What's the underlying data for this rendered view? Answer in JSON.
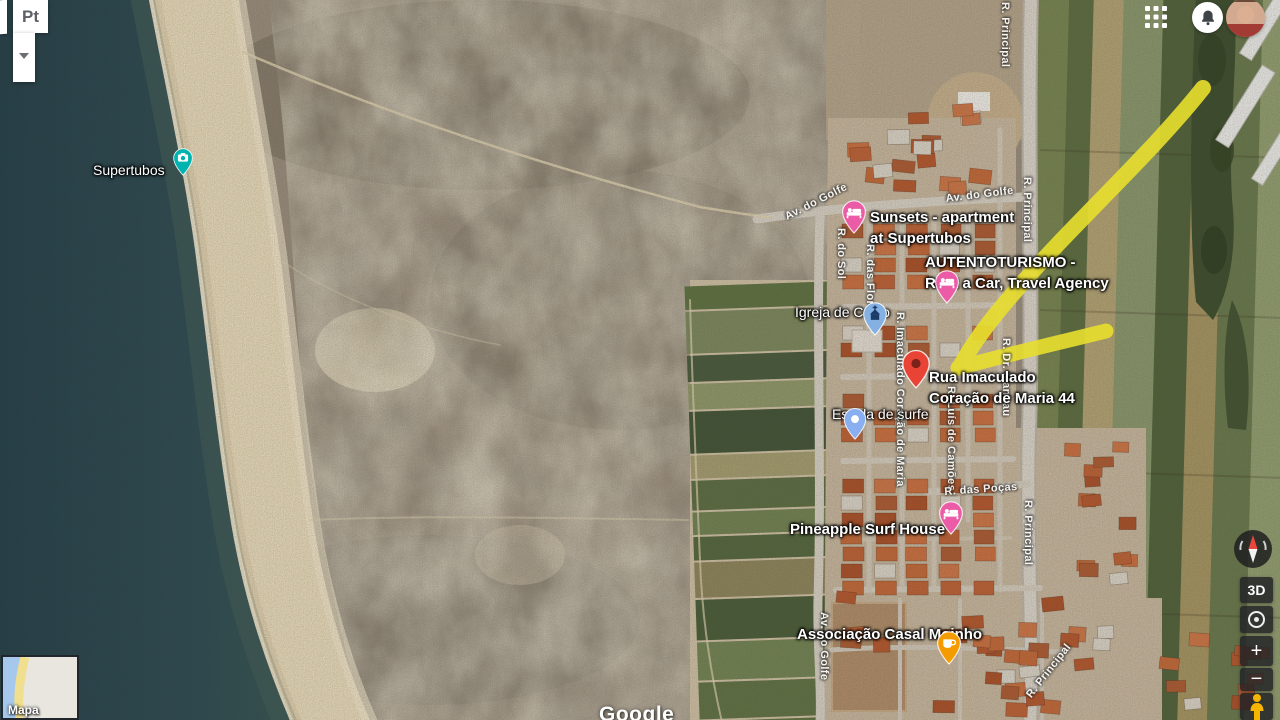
{
  "ui": {
    "language": {
      "label": "Pt"
    },
    "topbar": {
      "apps_grid_icon": "apps-grid-icon",
      "notifications_icon": "bell-icon",
      "avatar": "user-avatar"
    },
    "controls": {
      "compass_icon": "compass-icon",
      "three_d_label": "3D",
      "my_location_icon": "my-location-icon",
      "zoom_in_label": "+",
      "zoom_out_label": "−",
      "pegman_icon": "pegman-icon"
    },
    "minimap": {
      "label": "Mapa"
    },
    "watermark": "Google"
  },
  "colors": {
    "annotation_arrow": "#e8df2e",
    "water": "#27434c",
    "sand": "#e6d8b8",
    "destination_pin": "#e94335",
    "destination_pin_hole": "#7a211a",
    "lodging_pin": "#ec5ba6",
    "photo_pin": "#00b3af",
    "church_pin": "#84b1e2",
    "church_icon": "#1c3a66",
    "cafe_pin": "#f49b00",
    "poi_pin": "#8aaff0"
  },
  "poi_labels": [
    {
      "name": "label-supertubos",
      "lines": [
        "Supertubos"
      ],
      "x": 93,
      "y": 160,
      "size": 14,
      "weight": "400"
    },
    {
      "name": "label-sunsets-apartment",
      "lines": [
        "Sunsets - apartment",
        "at Supertubos"
      ],
      "x": 870,
      "y": 207,
      "size": 15,
      "weight": "700"
    },
    {
      "name": "label-autentoturismo",
      "lines": [
        "AUTENTOTURISMO -",
        "Rent a Car, Travel Agency"
      ],
      "x": 925,
      "y": 252,
      "size": 15,
      "weight": "700"
    },
    {
      "name": "label-igreja-de-cristo",
      "lines": [
        "Igreja de Cristo"
      ],
      "x": 795,
      "y": 302,
      "size": 14,
      "weight": "400"
    },
    {
      "name": "label-rua-imaculado-44",
      "lines": [
        "Rua Imaculado",
        "Coração de Maria 44"
      ],
      "x": 929,
      "y": 367,
      "size": 15,
      "weight": "700"
    },
    {
      "name": "label-escola-de-surfe",
      "lines": [
        "Escola de surfe"
      ],
      "x": 832,
      "y": 404,
      "size": 14,
      "weight": "400"
    },
    {
      "name": "label-pineapple-surf-house",
      "lines": [
        "Pineapple Surf House"
      ],
      "x": 790,
      "y": 519,
      "size": 15,
      "weight": "700"
    },
    {
      "name": "label-associacao-casal-moinho",
      "lines": [
        "Associação Casal Moinho"
      ],
      "x": 797,
      "y": 624,
      "size": 15,
      "weight": "700"
    }
  ],
  "road_labels": [
    {
      "text": "Av. do Golfe",
      "x": 783,
      "y": 212,
      "rotate": -27
    },
    {
      "text": "Av. do Golfe",
      "x": 945,
      "y": 193,
      "rotate": -7
    },
    {
      "text": "R. Principal",
      "x": 999,
      "y": 2,
      "vertical": true
    },
    {
      "text": "R. Principal",
      "x": 1021,
      "y": 177,
      "vertical": true
    },
    {
      "text": "R. do Sol",
      "x": 835,
      "y": 228,
      "vertical": true
    },
    {
      "text": "R. das Flores",
      "x": 864,
      "y": 244,
      "vertical": true
    },
    {
      "text": "R. Imaculado Coração de Maria",
      "x": 894,
      "y": 312,
      "vertical": true
    },
    {
      "text": "R. Luís de Camões",
      "x": 945,
      "y": 386,
      "vertical": true
    },
    {
      "text": "R. Dr. Manhau",
      "x": 1000,
      "y": 338,
      "vertical": true
    },
    {
      "text": "R. das Poças",
      "x": 944,
      "y": 486,
      "rotate": -4
    },
    {
      "text": "R. Principal",
      "x": 1022,
      "y": 500,
      "vertical": true
    },
    {
      "text": "Av. do Golfe",
      "x": 818,
      "y": 612,
      "vertical": true
    },
    {
      "text": "R. Principal",
      "x": 1024,
      "y": 693,
      "rotate": -52
    }
  ],
  "pins": [
    {
      "name": "photo-spot-pin-supertubos",
      "icon": "camera-icon",
      "color_key": "photo_pin",
      "x": 183,
      "y": 181,
      "s": 0.78
    },
    {
      "name": "lodging-pin-sunsets",
      "icon": "bed-icon",
      "color_key": "lodging_pin",
      "x": 854,
      "y": 239,
      "s": 0.95
    },
    {
      "name": "lodging-pin-autentoturismo",
      "icon": "bed-icon",
      "color_key": "lodging_pin",
      "x": 947,
      "y": 309,
      "s": 0.95
    },
    {
      "name": "church-pin-igreja-de-cristo",
      "icon": "church-icon",
      "color_key": "church_pin",
      "x": 875,
      "y": 341,
      "s": 0.95
    },
    {
      "name": "destination-pin-rua-imaculado-44",
      "icon": "hole-icon",
      "color_key": "destination_pin",
      "x": 916,
      "y": 394,
      "s": 1.1
    },
    {
      "name": "poi-pin-escola-de-surfe",
      "icon": "dot-icon",
      "color_key": "poi_pin",
      "x": 855,
      "y": 445,
      "s": 0.9
    },
    {
      "name": "lodging-pin-pineapple",
      "icon": "bed-icon",
      "color_key": "lodging_pin",
      "x": 951,
      "y": 540,
      "s": 0.95
    },
    {
      "name": "cafe-pin-associacao",
      "icon": "cup-icon",
      "color_key": "cafe_pin",
      "x": 949,
      "y": 670,
      "s": 0.95
    }
  ]
}
